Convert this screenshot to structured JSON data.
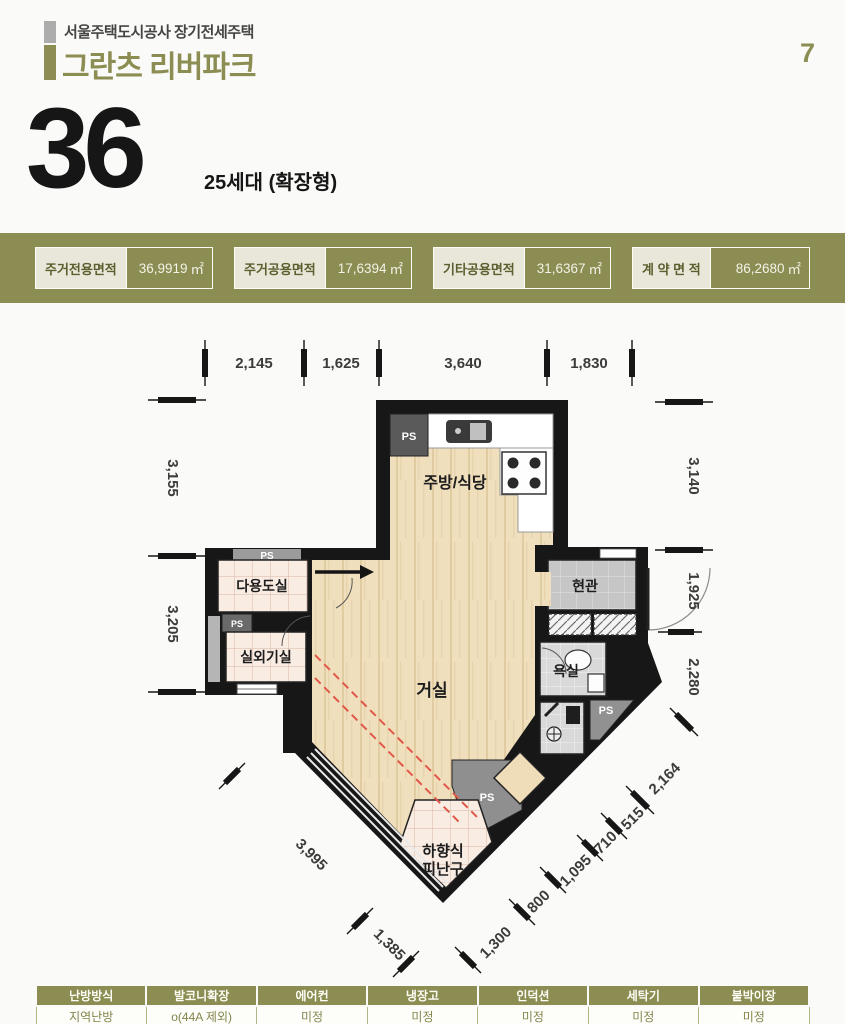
{
  "header": {
    "agency_line": "서울주택도시공사 장기전세주택",
    "title": "그란츠 리버파크",
    "page_number": "7",
    "unit_number": "36",
    "unit_detail": "25세대 (확장형)"
  },
  "area_summary": {
    "items": [
      {
        "label": "주거전용면적",
        "value": "36,9919",
        "unit": "㎡"
      },
      {
        "label": "주거공용면적",
        "value": "17,6394",
        "unit": "㎡"
      },
      {
        "label": "기타공용면적",
        "value": "31,6367",
        "unit": "㎡"
      },
      {
        "label": "계 약 면 적",
        "value": "86,2680",
        "unit": "㎡"
      }
    ]
  },
  "floorplan": {
    "rooms": {
      "kitchen": "주방/식당",
      "living": "거실",
      "utility": "다용도실",
      "outdoor_unit": "실외기실",
      "entrance": "현관",
      "bathroom": "욕실",
      "escape_hatch_line1": "하향식",
      "escape_hatch_line2": "피난구",
      "ps": "PS"
    },
    "dims": {
      "top": [
        "2,145",
        "1,625",
        "3,640",
        "1,830"
      ],
      "left": [
        "3,155",
        "3,205"
      ],
      "right": [
        "3,140",
        "1,925",
        "2,280"
      ],
      "diag_right": "2,164",
      "bottom_left": [
        "3,995",
        "1,385"
      ],
      "bottom_right": [
        "1,300",
        "800",
        "1,095",
        "710",
        "515"
      ]
    }
  },
  "options_table": {
    "headers": [
      "난방방식",
      "발코니확장",
      "에어컨",
      "냉장고",
      "인덕션",
      "세탁기",
      "붙박이장"
    ],
    "values": [
      "지역난방",
      "o(44A 제외)",
      "미정",
      "미정",
      "미정",
      "미정",
      "미정"
    ]
  },
  "colors": {
    "accent_olive": "#8b8d52",
    "wall_black": "#171717",
    "balcony_line_red": "#e05848"
  }
}
